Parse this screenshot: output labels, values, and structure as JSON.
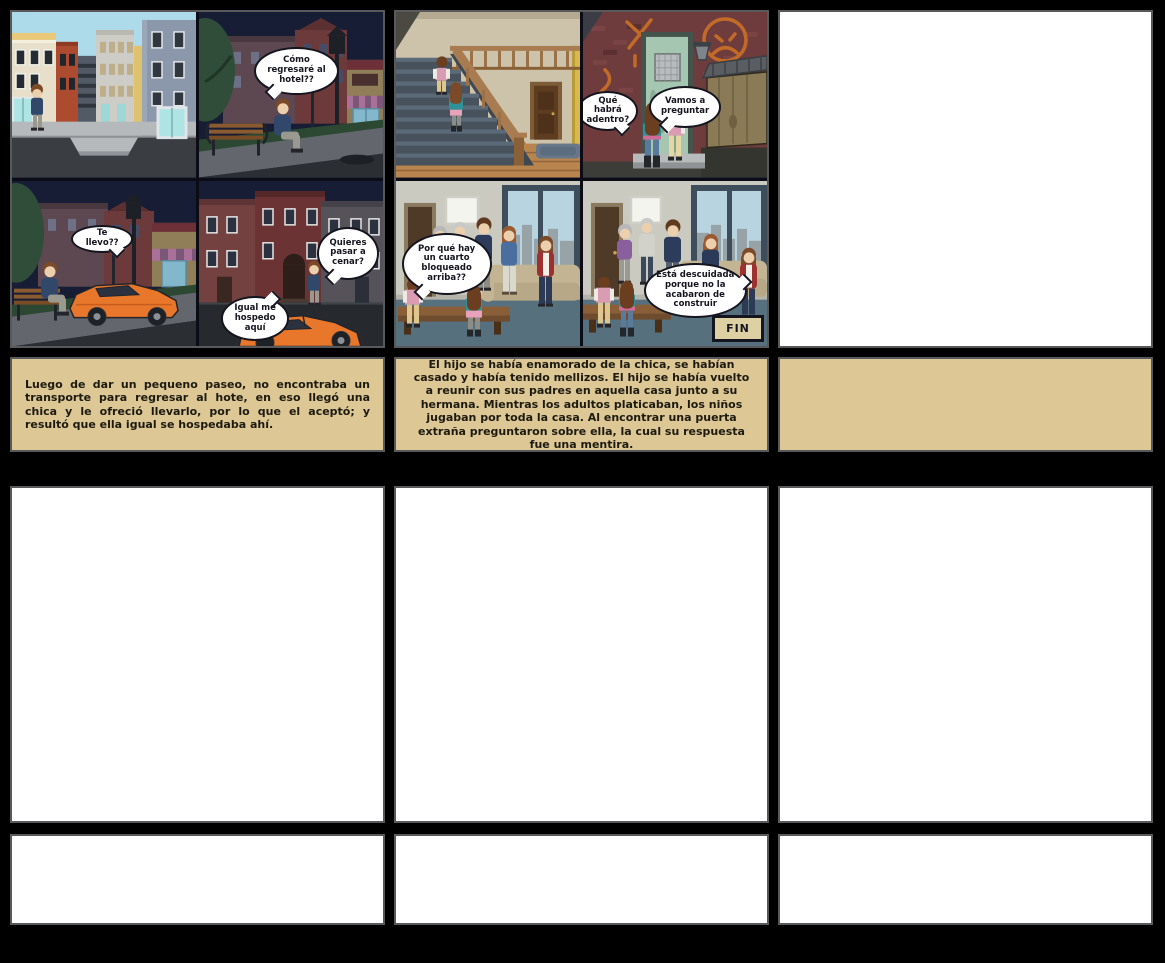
{
  "board": {
    "background": "#000000",
    "cell_border_color": "#58595b",
    "caption_bg": "#dcc795",
    "empty_cell_bg": "#ffffff",
    "fin_bg": "#ddd0a2",
    "car_orange": "#e8772b"
  },
  "comic1": {
    "panel1": {
      "scene": "city-street-day"
    },
    "panel2": {
      "scene": "night-bench",
      "bubble": "Cómo regresaré al hotel??"
    },
    "panel3": {
      "scene": "night-bench-car",
      "bubble": "Te llevo??"
    },
    "panel4": {
      "scene": "night-brick-street",
      "bubble_right": "Quieres pasar a cenar?",
      "bubble_left": "Igual me hospedo aquí"
    }
  },
  "comic2": {
    "panel1": {
      "scene": "interior-staircase"
    },
    "panel2": {
      "scene": "graffiti-door",
      "bubble_left": "Qué habrá adentro?",
      "bubble_right": "Vamos a preguntar"
    },
    "panel3": {
      "scene": "living-room-group",
      "bubble": "Por qué hay un cuarto bloqueado arriba??"
    },
    "panel4": {
      "scene": "living-room-end",
      "bubble": "Está descuidada porque no la acabaron de construir",
      "fin_label": "FIN"
    }
  },
  "captions": {
    "row1_col1": "Luego de dar un pequeno paseo, no encontraba un transporte para regresar al hote, en eso llegó una chica y le ofreció llevarlo, por lo que el aceptó; y resultó que ella igual se hospedaba ahí.",
    "row1_col2": "El hijo se había enamorado de la chica, se habían casado y había tenido mellizos. El hijo se había vuelto a reunir con sus padres en aquella casa junto a su hermana. Mientras los adultos platicaban, los niños jugaban por toda la casa. Al encontrar una puerta extraña preguntaron sobre ella, la cual su respuesta fue una mentira.",
    "row1_col3": ""
  }
}
